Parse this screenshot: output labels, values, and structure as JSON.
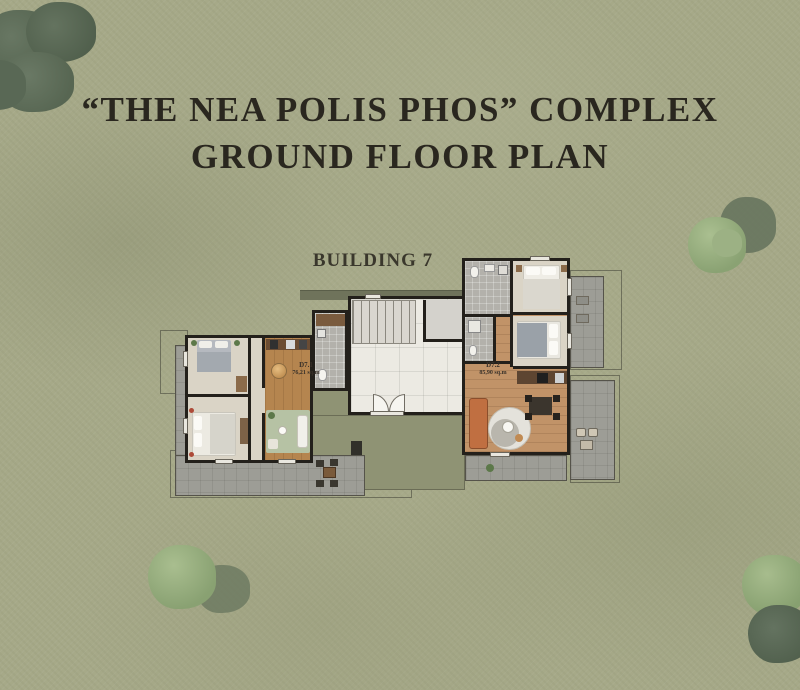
{
  "title": {
    "line1": "“THE NEA POLIS PHOS” COMPLEX",
    "line2": "GROUND FLOOR PLAN"
  },
  "building": {
    "label": "BUILDING 7"
  },
  "units": [
    {
      "id": "D7.1",
      "area": "76,21 sq.m"
    },
    {
      "id": "D7.2",
      "area": "85,90 sq.m"
    }
  ],
  "palette": {
    "grass": "#a6a988",
    "tree_dark": "#5d6c5a",
    "tree_light": "#93aa7c",
    "wall": "#23201b",
    "wood_left": "#b5854f",
    "wood_right": "#c19368",
    "stone_terrace": "#9d9d96",
    "paved_court": "#8f9374",
    "marble": "#eceae3",
    "sofa_accent": "#c06f41",
    "title_text": "#2a271f"
  }
}
